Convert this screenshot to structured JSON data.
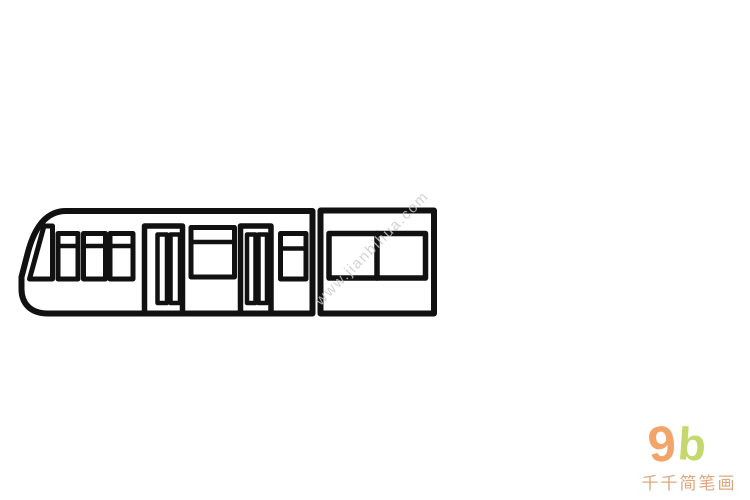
{
  "illustration": {
    "subject": "tram-line-drawing",
    "style": "simple outline drawing (jianbihua)",
    "stroke_color": "#111111",
    "background_color": "#ffffff"
  },
  "watermark": {
    "text": "www.jianbihua.com",
    "color": "#c9c9c9"
  },
  "logo": {
    "char_nine": "9",
    "char_b": "b",
    "nine_color": "#f3a469",
    "b_color": "#c4d86c",
    "brand_text": "千千简笔画",
    "brand_color": "#dfa77d"
  }
}
